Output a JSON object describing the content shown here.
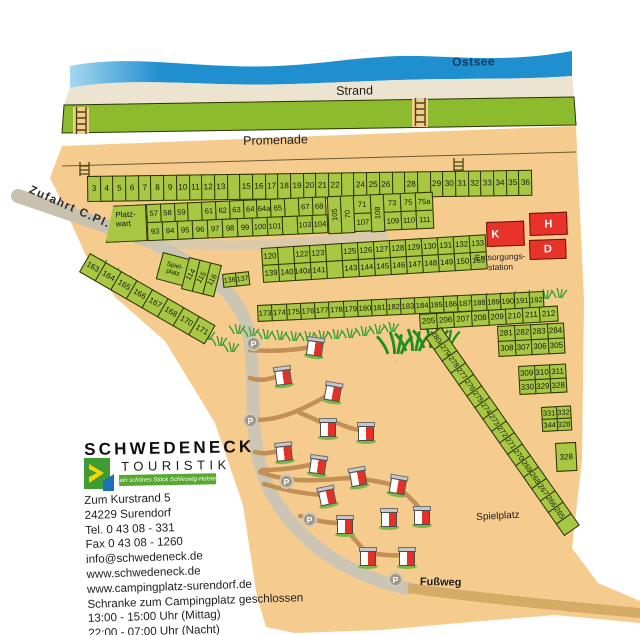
{
  "labels": {
    "ostsee": "Ostsee",
    "strand": "Strand",
    "promenade": "Promenade",
    "zufahrt": "Zufahrt C.Pl.",
    "platzwart1": "Platz-",
    "platzwart2": "wart",
    "entsorgung1": "Entsorgungs-",
    "entsorgung2": "station",
    "spiel_small1": "Spiel-",
    "spiel_small2": "platz",
    "spielplatz": "Spielplatz",
    "fussweg": "Fußweg",
    "parking": "P"
  },
  "buildings": {
    "k": "K",
    "h": "H",
    "d": "D"
  },
  "plots": {
    "row1": [
      "3",
      "4",
      "5",
      "6",
      "7",
      "8",
      "9",
      "10",
      "11",
      "12",
      "13",
      "",
      "15",
      "16",
      "17",
      "18",
      "19",
      "20",
      "21",
      "22",
      "",
      "24",
      "25",
      "26",
      "",
      "28",
      "",
      "29",
      "30",
      "31",
      "32",
      "33",
      "34",
      "35",
      "36"
    ],
    "row2_top": [
      "57",
      "58",
      "59",
      "",
      "61",
      "62",
      "63",
      "64",
      "64a",
      "65",
      "",
      "67",
      "68"
    ],
    "row2_bottom": [
      "93",
      "94",
      "95",
      "96",
      "97",
      "98",
      "99",
      "100",
      "101",
      "",
      "103",
      "104"
    ],
    "p105": "105",
    "p70": "70",
    "p108": "108",
    "tail_top": [
      "71",
      "73",
      "75",
      "75a"
    ],
    "tail_bottom": [
      "107",
      "109",
      "110",
      "111"
    ],
    "chain_left": [
      "163",
      "164",
      "165",
      "166",
      "167",
      "168",
      "170",
      "171"
    ],
    "verticals": [
      "114",
      "115",
      "116"
    ],
    "pair": [
      "136",
      "137"
    ],
    "row3_top": [
      "120",
      "",
      "122",
      "123",
      "",
      "125",
      "126",
      "127",
      "128",
      "129",
      "130",
      "131",
      "132",
      "133"
    ],
    "row3_bottom": [
      "139",
      "140",
      "140a",
      "141",
      "",
      "143",
      "144",
      "145",
      "146",
      "147",
      "148",
      "149",
      "150",
      "151"
    ],
    "row4": [
      "173",
      "174",
      "175",
      "176",
      "177",
      "178",
      "179",
      "180",
      "181",
      "182",
      "183",
      "184",
      "185",
      "186",
      "187",
      "188",
      "189",
      "190",
      "191",
      "192"
    ],
    "row5": [
      "205",
      "206",
      "207",
      "208",
      "209",
      "210",
      "211",
      "212"
    ],
    "blockA_top": [
      "281",
      "282",
      "283",
      "284"
    ],
    "blockA_bottom": [
      "308",
      "307",
      "306",
      "305"
    ],
    "blockB_top": [
      "309",
      "310",
      "311"
    ],
    "blockB_bottom": [
      "330",
      "329",
      "328"
    ],
    "blockC_top": [
      "331",
      "332"
    ],
    "blockC_bottom": [
      "344",
      "328"
    ],
    "single": "328",
    "chain_right": [
      "280a",
      "279",
      "278",
      "277",
      "276",
      "275",
      "274",
      "273",
      "272",
      "271",
      "270",
      "269",
      "268",
      "267",
      "266",
      "265",
      ""
    ]
  },
  "logo": {
    "line1": "SCHWEDENECK",
    "line2": "TOURISTIK",
    "banner": "...ein schönes Stück Schleswig-Holstein"
  },
  "address": {
    "lines": [
      "Zum Kurstrand 5",
      "24229 Surendorf",
      "Tel. 0 43 08 - 331",
      "Fax 0 43 08 - 1260",
      "info@schwedeneck.de",
      "www.schwedeneck.de",
      "www.campingplatz-surendorf.de",
      "Schranke zum Campingplatz geschlossen",
      "13:00 - 15:00 Uhr (Mittag)",
      "22:00 - 07:00 Uhr (Nacht)"
    ]
  },
  "colors": {
    "sand": "#f6cb8e",
    "water": "#1f8fcf",
    "plot_green": "#a8c844",
    "building_red": "#e8332a"
  }
}
